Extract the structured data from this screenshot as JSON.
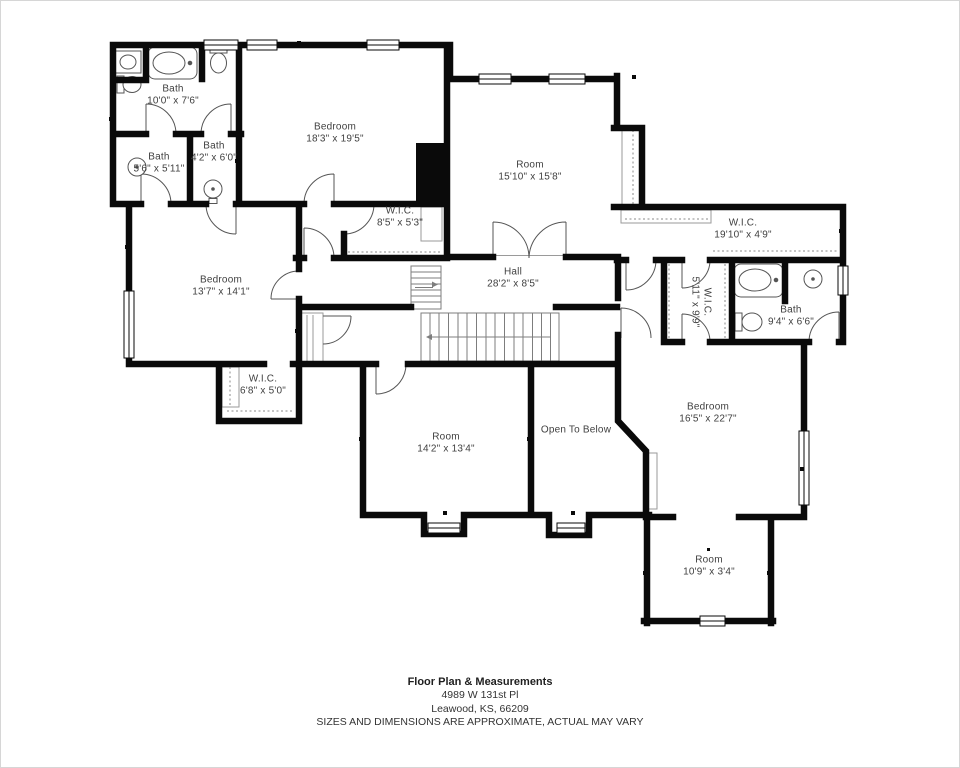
{
  "plan": {
    "rooms": [
      {
        "name": "Bath",
        "dims": "10'0\" x 7'6\""
      },
      {
        "name": "Bath",
        "dims": "5'6\" x 5'11\""
      },
      {
        "name": "Bath",
        "dims": "4'2\" x 6'0\""
      },
      {
        "name": "Bedroom",
        "dims": "18'3\" x 19'5\""
      },
      {
        "name": "Room",
        "dims": "15'10\" x 15'8\""
      },
      {
        "name": "W.I.C.",
        "dims": "8'5\" x 5'3\""
      },
      {
        "name": "W.I.C.",
        "dims": "19'10\" x 4'9\""
      },
      {
        "name": "Bedroom",
        "dims": "13'7\" x 14'1\""
      },
      {
        "name": "Hall",
        "dims": "28'2\" x 8'5\""
      },
      {
        "name": "W.I.C.",
        "dims": "5'11\" x 9'9\""
      },
      {
        "name": "Bath",
        "dims": "9'4\" x 6'6\""
      },
      {
        "name": "W.I.C.",
        "dims": "6'8\" x 5'0\""
      },
      {
        "name": "Room",
        "dims": "14'2\" x 13'4\""
      },
      {
        "name": "Open To Below",
        "dims": ""
      },
      {
        "name": "Bedroom",
        "dims": "16'5\" x 22'7\""
      },
      {
        "name": "Room",
        "dims": "10'9\" x 3'4\""
      }
    ],
    "footer": {
      "title": "Floor Plan & Measurements",
      "address_line1": "4989 W 131st Pl",
      "address_line2": "Leawood, KS, 66209",
      "disclaimer": "SIZES AND DIMENSIONS ARE APPROXIMATE, ACTUAL MAY VARY"
    },
    "colors": {
      "wall": "#0a0a0a",
      "background": "#ffffff",
      "label": "#3f3f3f",
      "thin_line": "#8a8a8a"
    },
    "icons": [
      "bathtub-icon",
      "toilet-icon",
      "sink-icon",
      "door-arc-icon",
      "window-icon",
      "stairs-icon",
      "closet-rod-icon"
    ]
  }
}
